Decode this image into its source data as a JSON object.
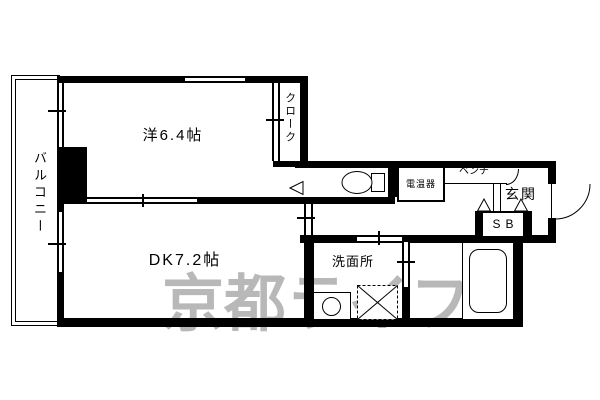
{
  "labels": {
    "balcony": "バルコニー",
    "western_room": "洋6.4帖",
    "closet": "クローク",
    "dining_kitchen": "DK7.2帖",
    "washroom": "洗面所",
    "water_heater": "電温器",
    "bench": "ベンチ",
    "entrance": "玄関",
    "shoe_box": "SB"
  },
  "watermark": {
    "text": "京都ライフ",
    "color": "#b8b8b8"
  },
  "colors": {
    "wall": "#000000",
    "floor": "#ffffff"
  }
}
